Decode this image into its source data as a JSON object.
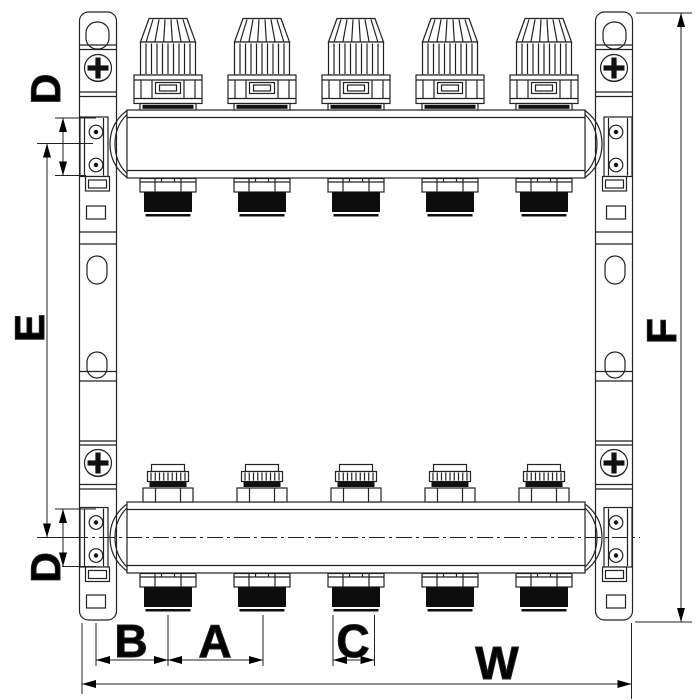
{
  "drawing": {
    "background": "#ffffff",
    "line_color": "#222222",
    "thread_color": "#0d0d0d",
    "label_color": "#000000",
    "circuits": 5,
    "labels": {
      "d_top": "D",
      "e": "E",
      "f": "F",
      "d_bottom": "D",
      "b": "B",
      "a": "A",
      "c": "C",
      "w": "W"
    },
    "components": {
      "thermostatic_valve_caps": 5,
      "lockshield_caps": 5,
      "threaded_outlets_top": 5,
      "threaded_outlets_bottom": 5,
      "mounting_brackets": 2,
      "manifold_bars": 2
    }
  }
}
